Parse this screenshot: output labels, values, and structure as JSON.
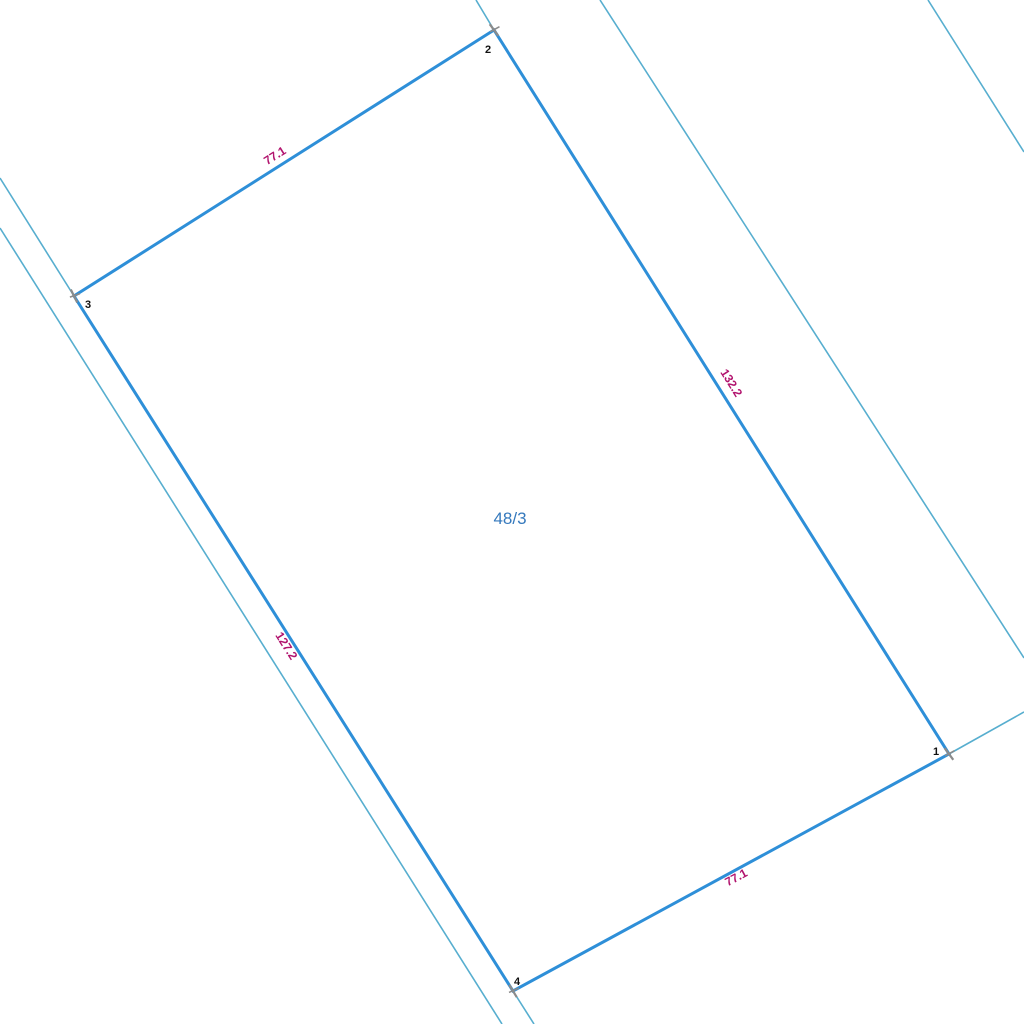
{
  "map": {
    "background_color": "#ffffff",
    "parcel": {
      "id_label": "48/3",
      "id_label_color": "#3579bd",
      "id_label_pos": {
        "x": 510,
        "y": 524
      },
      "boundary_color": "#2e8fd8",
      "boundary_width": 3,
      "vertices": [
        {
          "n": "2",
          "x": 494,
          "y": 30,
          "label_x": 488,
          "label_y": 53,
          "mark_angle": 20
        },
        {
          "n": "3",
          "x": 74,
          "y": 296,
          "label_x": 88,
          "label_y": 308,
          "mark_angle": 30
        },
        {
          "n": "4",
          "x": 513,
          "y": 991,
          "label_x": 517,
          "label_y": 985,
          "mark_angle": 25
        },
        {
          "n": "1",
          "x": 949,
          "y": 754,
          "label_x": 936,
          "label_y": 755,
          "mark_angle": 20
        }
      ],
      "vertex_mark_color": "#8b8b8b",
      "vertex_number_color": "#111111",
      "edge_labels": [
        {
          "text": "77.1",
          "x": 277,
          "y": 159,
          "angle": -32.4
        },
        {
          "text": "132.2",
          "x": 728,
          "y": 385,
          "angle": 57.9
        },
        {
          "text": "127.2",
          "x": 283,
          "y": 648,
          "angle": 57.7
        },
        {
          "text": "77.1",
          "x": 738,
          "y": 881,
          "angle": -28.3
        }
      ],
      "edge_label_color": "#b2146e"
    },
    "adjacent_lines": {
      "color": "#57aecf",
      "width": 1.6,
      "segments": [
        {
          "x1": 476,
          "y1": 0,
          "x2": 494,
          "y2": 30
        },
        {
          "x1": 0,
          "y1": 178,
          "x2": 74,
          "y2": 296
        },
        {
          "x1": 0,
          "y1": 228,
          "x2": 502,
          "y2": 1024
        },
        {
          "x1": 513,
          "y1": 991,
          "x2": 534,
          "y2": 1024
        },
        {
          "x1": 600,
          "y1": 0,
          "x2": 1024,
          "y2": 658
        },
        {
          "x1": 928,
          "y1": 0,
          "x2": 1024,
          "y2": 152
        },
        {
          "x1": 949,
          "y1": 754,
          "x2": 1024,
          "y2": 712
        }
      ]
    }
  }
}
